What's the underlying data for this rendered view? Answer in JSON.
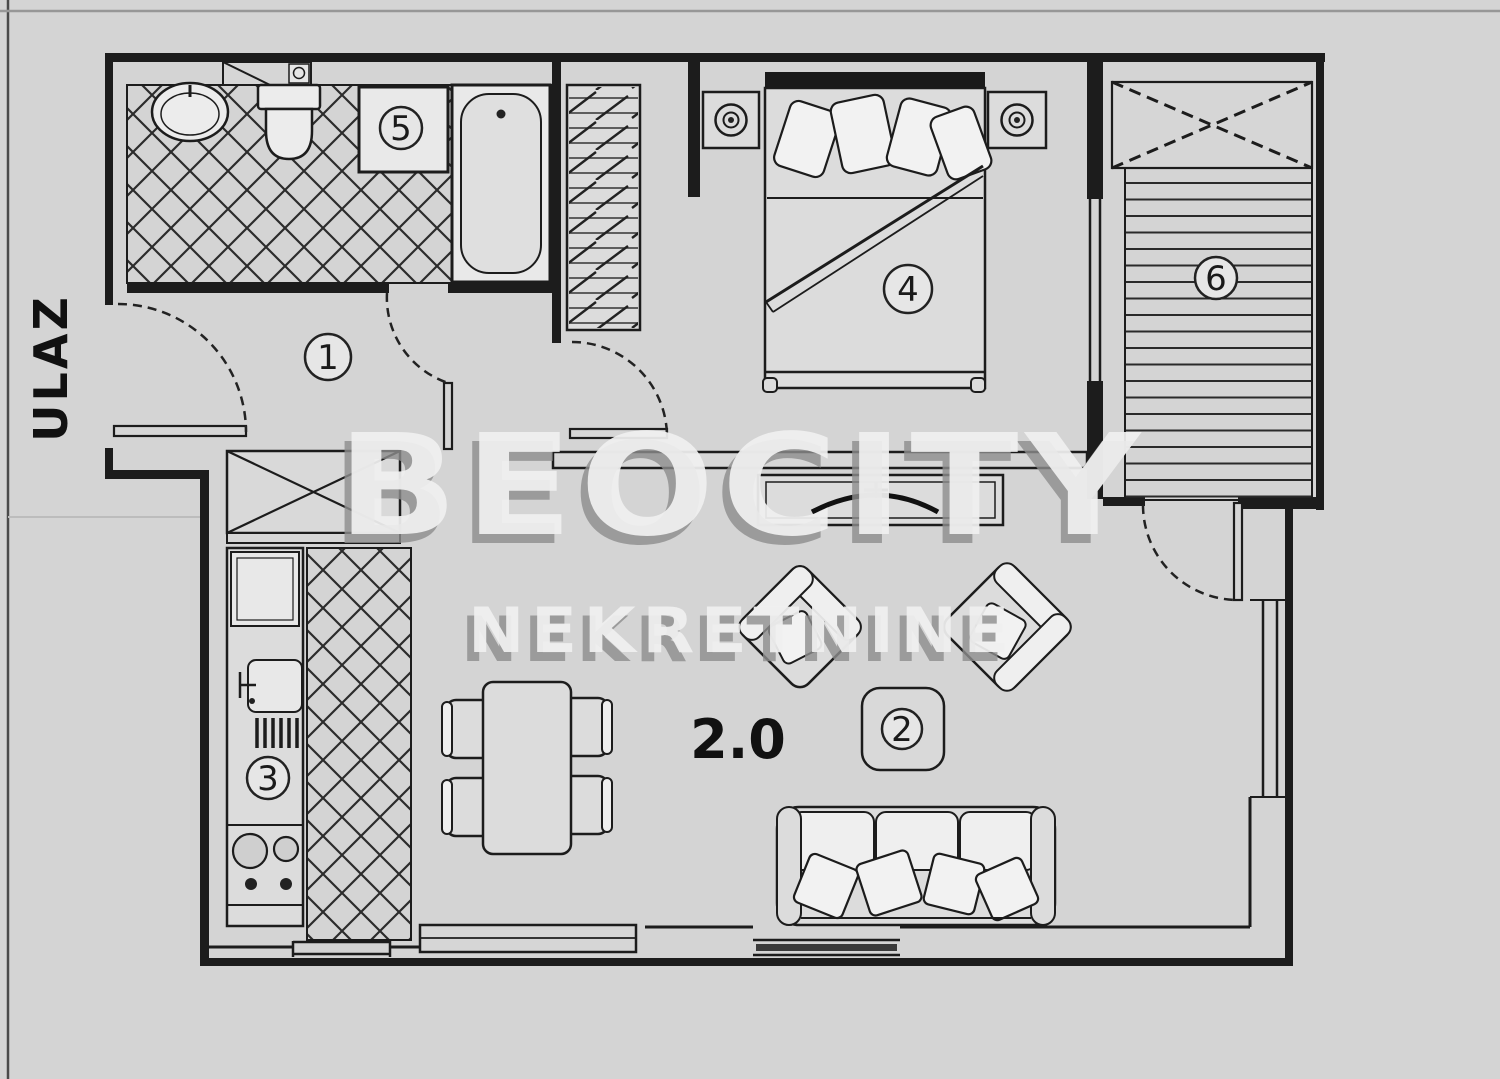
{
  "plan": {
    "entrance_label": "ULAZ",
    "area_label": "2.0",
    "watermark": {
      "line1": "BEOCITY",
      "line2": "NEKRETNINE"
    },
    "rooms": [
      {
        "number": "1"
      },
      {
        "number": "2"
      },
      {
        "number": "3"
      },
      {
        "number": "4"
      },
      {
        "number": "5"
      },
      {
        "number": "6"
      }
    ],
    "colors": {
      "background": "#d4d4d4",
      "line": "#1c1c1c",
      "watermark_face": "#f0f0f0",
      "watermark_shadow": "#8e8e8e",
      "window_band": "#3a3a3a"
    }
  }
}
